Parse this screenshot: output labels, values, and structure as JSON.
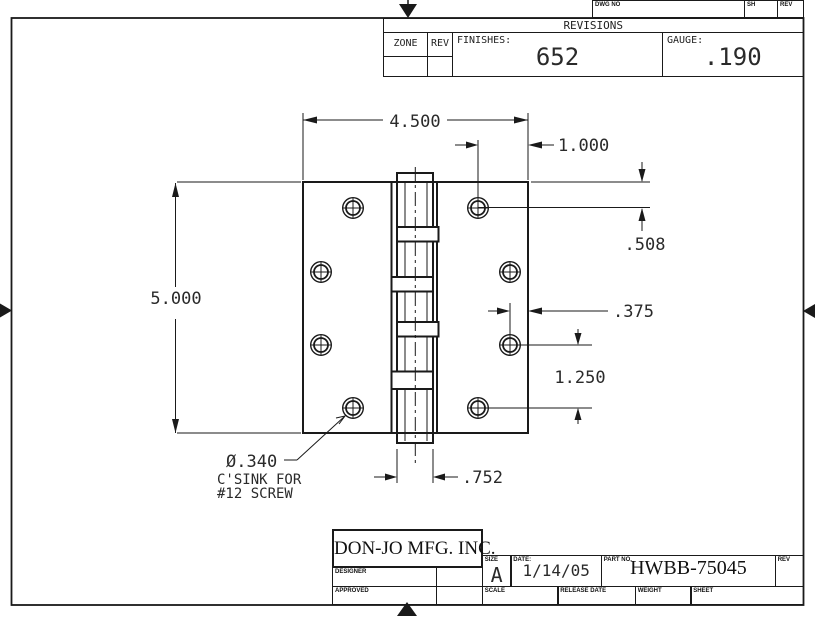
{
  "page": {
    "background": "#ffffff",
    "line_color": "#1a1a1a"
  },
  "top_strip": {
    "dwg_no_label": "DWG NO",
    "sh_label": "SH",
    "rev_label": "REV"
  },
  "revisions": {
    "title": "REVISIONS",
    "zone_label": "ZONE",
    "rev_label": "REV",
    "finishes_label": "FINISHES:",
    "finishes_value": "652",
    "gauge_label": "GAUGE:",
    "gauge_value": ".190"
  },
  "dimensions": {
    "overall_width": "4.500",
    "overall_height": "5.000",
    "hole_col_inset": "1.000",
    "top_edge_to_hole": ".508",
    "edge_to_hole": ".375",
    "hole_spacing": "1.250",
    "barrel_width": ".752",
    "csink_diameter": "Ø.340",
    "csink_note_line2": "C'SINK FOR",
    "csink_note_line3": "#12 SCREW"
  },
  "title_block": {
    "company": "DON-JO MFG. INC.",
    "designer_label": "DESIGNER",
    "approved_label": "APPROVED",
    "size_label": "SIZE",
    "size_value": "A",
    "date_label": "DATE:",
    "date_value": "1/14/05",
    "part_no_label": "PART NO.",
    "part_no_value": "HWBB-75045",
    "rev_label": "REV",
    "scale_label": "SCALE",
    "release_date_label": "RELEASE DATE",
    "weight_label": "WEIGHT",
    "sheet_label": "SHEET"
  }
}
